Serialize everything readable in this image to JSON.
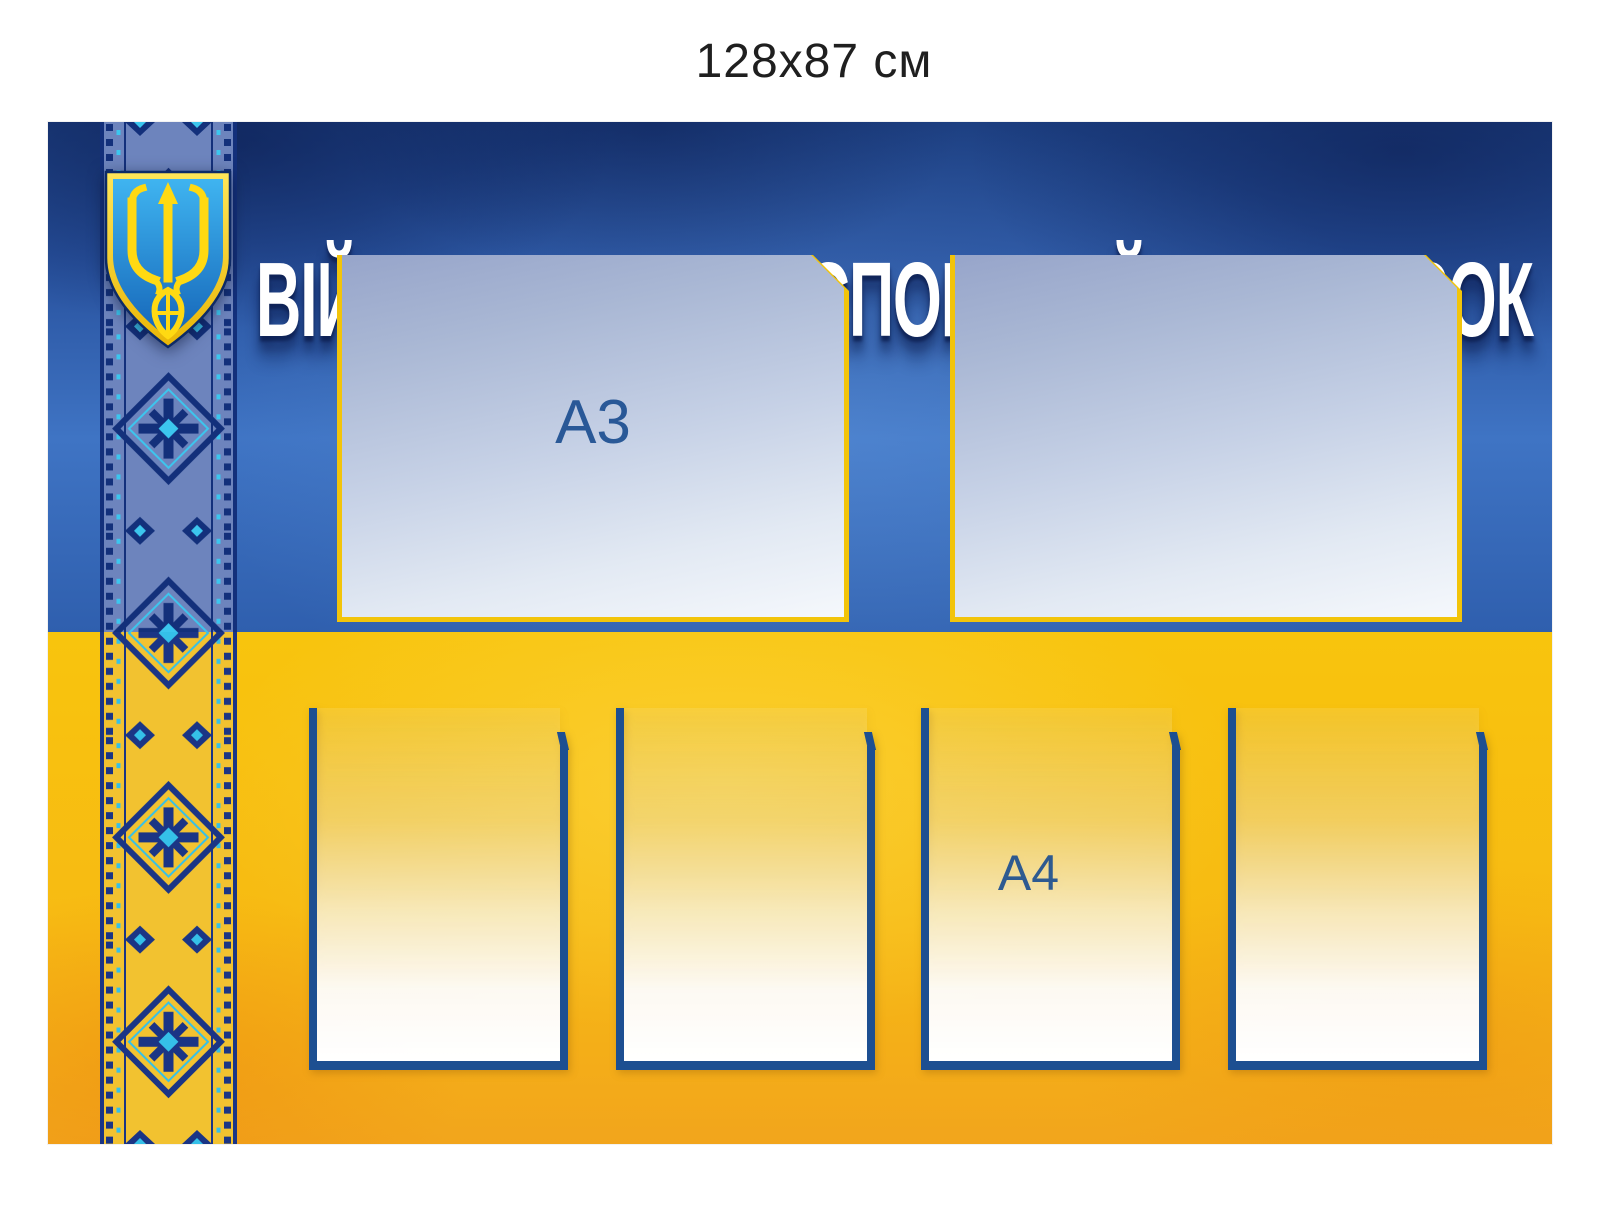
{
  "size_label": "128x87 см",
  "board": {
    "title": "ВІЙСЬКОВО-ТРАНСПОРТНИЙ ОБОВ’ЯЗОК",
    "emblem_icon": "ukraine-trident-coat-of-arms",
    "ornament_icon": "vyshyvanka-embroidery-stripe",
    "pockets_a3": [
      {
        "label": "A3"
      },
      {
        "label": ""
      }
    ],
    "pockets_a4": [
      {
        "label": ""
      },
      {
        "label": ""
      },
      {
        "label": "A4"
      },
      {
        "label": ""
      }
    ],
    "palette": {
      "page_bg": "#ffffff",
      "size_label_color": "#1f1f1f",
      "board_blue_top": "#1c3e80",
      "board_blue": "#2f5fae",
      "board_blue_bright": "#3f74c4",
      "board_yellow": "#f8c40d",
      "board_yellow_deep": "#f2a51c",
      "title_color": "#ffffff",
      "pocket_a3_border": "#f2c40a",
      "pocket_a3_bottom": "#f5f8fc",
      "pocket_a4_border": "#1d4f91",
      "pocket_label_color": "#1d4f91",
      "ornament_navy": "#13307b",
      "ornament_cyan": "#3cc6ee",
      "ornament_base_blue": "#6d84bd",
      "ornament_base_yellow": "#f2c230",
      "emblem_gold": "#ffd912",
      "emblem_shield_top": "#3fb4f0",
      "emblem_shield_bottom": "#1565b8",
      "emblem_outline": "#0d2a66"
    }
  }
}
